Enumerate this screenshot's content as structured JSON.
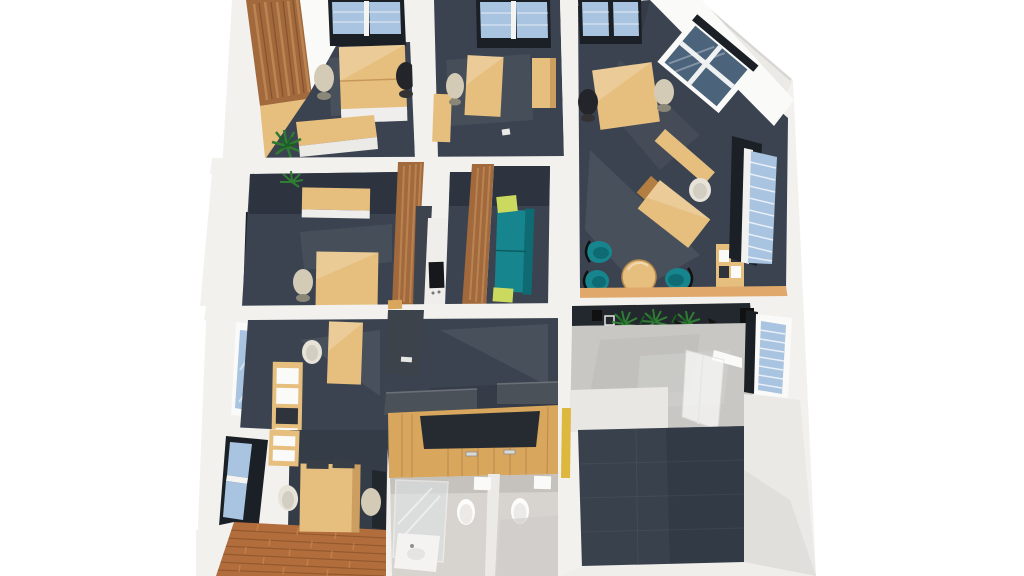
{
  "meta": {
    "description": "3D top-down dollhouse render of an office floor plan",
    "image_type": "architectural-3d-render"
  },
  "palette": {
    "background": "#ffffff",
    "wall_white": "#f2f1ee",
    "wall_bright": "#fafaf8",
    "wall_shadow": "#e2e1de",
    "carpet_navy": "#3b4350",
    "carpet_navy_dark": "#2d343f",
    "wall_dark": "#23282e",
    "wood_light": "#e6bf7e",
    "wood_mid": "#d8a75d",
    "wood_dark": "#b27e42",
    "wood_rustic": "#a2693c",
    "rustic_streak": "#c6925c",
    "rustic_shadow": "#6f4526",
    "parquet": "#b26d3d",
    "parquet_dark": "#7c481f",
    "parquet_light": "#d28a4e",
    "glass_blue": "#a9c4e0",
    "glass_dark": "#4c637c",
    "frame_black": "#1b2026",
    "teal": "#17858d",
    "teal_dark": "#0e6b74",
    "lime": "#ccd95f",
    "concrete": "#c8c7c3",
    "concrete_light": "#e8e7e4",
    "marble": "#d7d3cf",
    "marble_dark": "#c5c1bd",
    "fixture_white": "#fcfcfb",
    "chair_beige": "#d4cbb6",
    "chair_black": "#24242b",
    "chair_white": "#e7e3d9",
    "counter_gray": "#4b5158",
    "accent_yellow": "#ddb83e",
    "plant_green": "#2f7d33",
    "plant_dark": "#1b5e24",
    "glaze_white": "#f4f7fa"
  },
  "scene": {
    "rooms": [
      {
        "id": "office-top-left",
        "objects": [
          "wood-slat-wall",
          "skylight-window",
          "double-desk",
          "beige-chair",
          "black-chair",
          "sideboard",
          "plant"
        ]
      },
      {
        "id": "office-top-middle",
        "objects": [
          "skylight-window",
          "desk",
          "beige-chair",
          "tall-cabinet",
          "low-cabinet"
        ]
      },
      {
        "id": "office-top-right",
        "objects": [
          "skylight-window",
          "corner-picture-window",
          "desk",
          "black-chair",
          "beige-chair",
          "diagonal-credenza",
          "angled-desk",
          "white-chair",
          "teal-lounge-chairs",
          "round-table",
          "shelf-unit",
          "louver-window"
        ]
      },
      {
        "id": "office-mid-left",
        "objects": [
          "window",
          "plant",
          "wall-cabinets",
          "desk",
          "beige-chair"
        ]
      },
      {
        "id": "kitchenette",
        "objects": [
          "wood-partition",
          "appliance-column",
          "white-counter",
          "cooktop"
        ]
      },
      {
        "id": "lounge-nook",
        "objects": [
          "wood-partition",
          "teal-sofa",
          "lime-pillows"
        ]
      },
      {
        "id": "office-bottom-left",
        "objects": [
          "window",
          "shelving-unit",
          "desk",
          "white-chair",
          "dark-door"
        ]
      },
      {
        "id": "reception",
        "objects": [
          "gray-counter-top",
          "u-shaped-wood-counter",
          "handles"
        ]
      },
      {
        "id": "bathroom",
        "objects": [
          "shower-glass",
          "sink",
          "stall-divider",
          "toilet",
          "toilet",
          "cistern",
          "cistern"
        ]
      },
      {
        "id": "office-parquet",
        "objects": [
          "window",
          "wall-cabinet",
          "desk",
          "monitors",
          "office-chairs",
          "parquet-floor"
        ]
      },
      {
        "id": "open-room-bottom-right",
        "objects": [
          "planter-row",
          "plants",
          "concrete-floor",
          "leaning-glass-pane",
          "area-carpet",
          "louver-window",
          "yellow-wall-sliver"
        ]
      }
    ]
  }
}
